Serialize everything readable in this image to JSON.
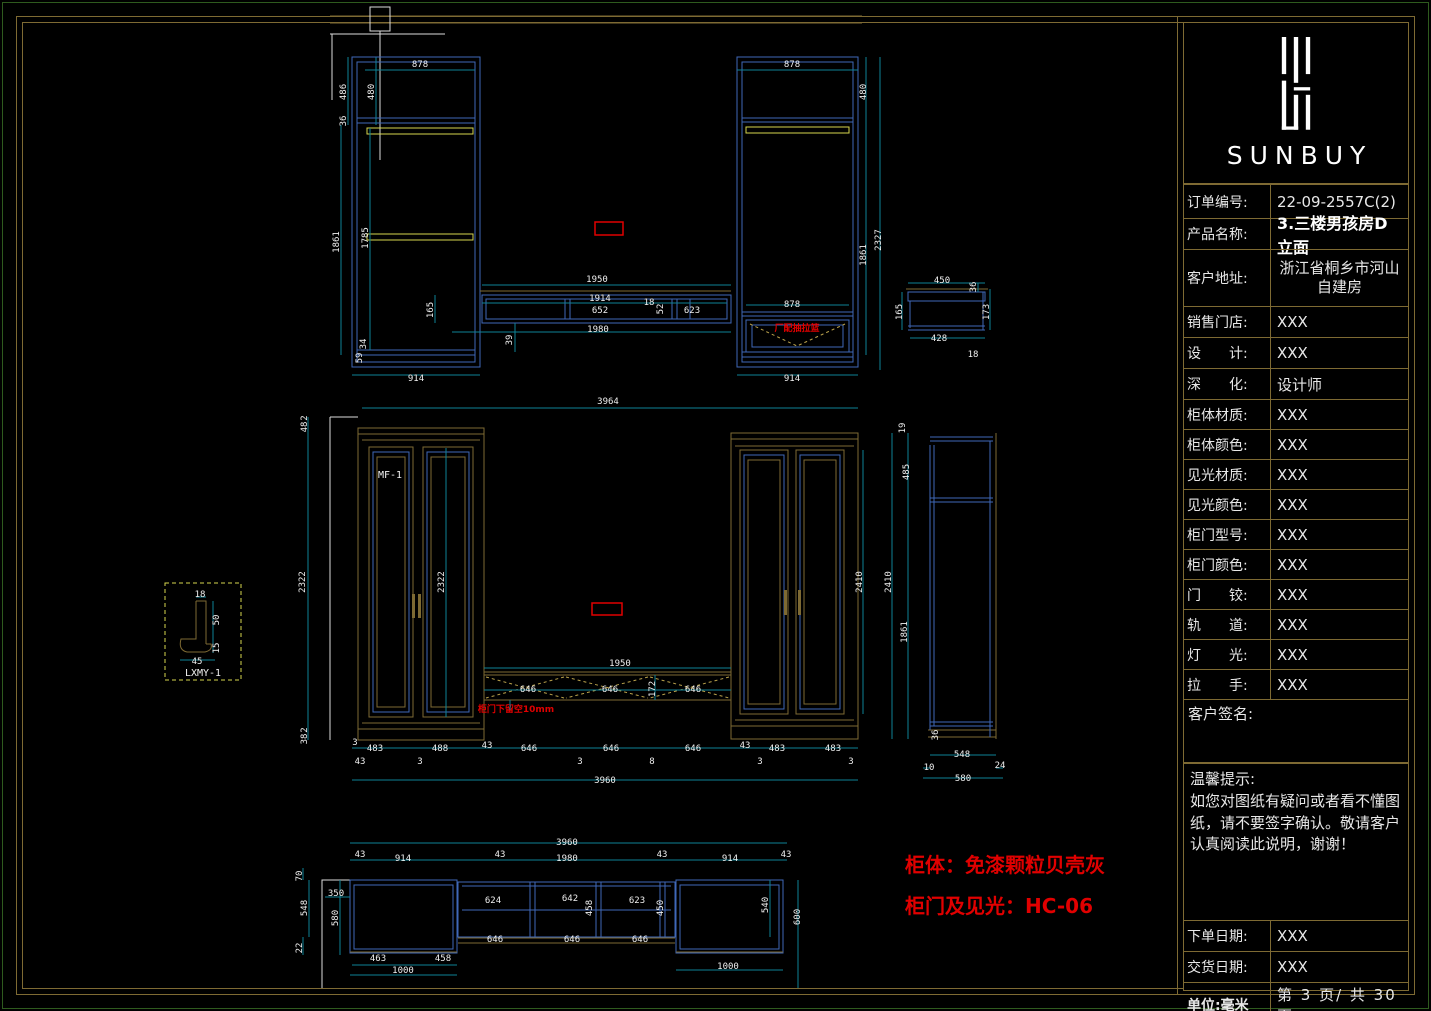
{
  "logo": {
    "brand": "SUNBUY"
  },
  "titleblock": {
    "rows": [
      {
        "label": "订单编号:",
        "value": "22-09-2557C(2)"
      },
      {
        "label": "产品名称:",
        "value": "3.三楼男孩房D立面"
      },
      {
        "label": "客户地址:",
        "value": "浙江省桐乡市河山自建房"
      },
      {
        "label": "销售门店:",
        "value": "XXX"
      },
      {
        "label": "设　　计:",
        "value": "XXX"
      },
      {
        "label": "深　　化:",
        "value": "设计师"
      },
      {
        "label": "柜体材质:",
        "value": "XXX"
      },
      {
        "label": "柜体颜色:",
        "value": "XXX"
      },
      {
        "label": "见光材质:",
        "value": "XXX"
      },
      {
        "label": "见光颜色:",
        "value": "XXX"
      },
      {
        "label": "柜门型号:",
        "value": "XXX"
      },
      {
        "label": "柜门颜色:",
        "value": "XXX"
      },
      {
        "label": "门　　铰:",
        "value": "XXX"
      },
      {
        "label": "轨　　道:",
        "value": "XXX"
      },
      {
        "label": "灯　　光:",
        "value": "XXX"
      },
      {
        "label": "拉　　手:",
        "value": "XXX"
      }
    ],
    "signature_label": "客户签名:",
    "notice_title": "温馨提示:",
    "notice_body": "如您对图纸有疑问或者看不懂图纸，请不要签字确认。敬请客户认真阅读此说明，谢谢！",
    "order_date_label": "下单日期:",
    "order_date": "XXX",
    "delivery_date_label": "交货日期:",
    "delivery_date": "XXX",
    "unit_label": "单位:毫米",
    "page_info": "第 3 页/ 共 30 页"
  },
  "notes": {
    "body_note": "柜体：免漆颗粒贝壳灰",
    "door_note": "柜门及见光：HC-06",
    "drawer_note": "厂配抽拉篮",
    "gap_note": "柜门下留空10mm"
  },
  "labels": {
    "door_model": "MF-1",
    "moulding_detail": "LXMY-1"
  },
  "colors": {
    "cad_blue": "#3f68b8",
    "cad_gold": "#7e6a33",
    "cad_yellow": "#d6d64e",
    "dim_cyan": "#0e8296",
    "note_red": "#e10000"
  },
  "dims": {
    "top": [
      {
        "x": 420,
        "y": 67,
        "t": "878"
      },
      {
        "x": 346,
        "y": 92,
        "t": "486",
        "r": 1
      },
      {
        "x": 374,
        "y": 92,
        "t": "480",
        "r": 1
      },
      {
        "x": 346,
        "y": 121,
        "t": "36",
        "r": 1
      },
      {
        "x": 339,
        "y": 242,
        "t": "1861",
        "r": 1
      },
      {
        "x": 368,
        "y": 238,
        "t": "1785",
        "r": 1
      },
      {
        "x": 366,
        "y": 344,
        "t": "34",
        "r": 1
      },
      {
        "x": 362,
        "y": 358,
        "t": "59",
        "r": 1
      },
      {
        "x": 416,
        "y": 381,
        "t": "914"
      },
      {
        "x": 597,
        "y": 282,
        "t": "1950"
      },
      {
        "x": 600,
        "y": 301,
        "t": "1914"
      },
      {
        "x": 600,
        "y": 313,
        "t": "652"
      },
      {
        "x": 649,
        "y": 305,
        "t": "18"
      },
      {
        "x": 663,
        "y": 309,
        "t": "52",
        "r": 1
      },
      {
        "x": 692,
        "y": 313,
        "t": "623"
      },
      {
        "x": 598,
        "y": 332,
        "t": "1980"
      },
      {
        "x": 433,
        "y": 310,
        "t": "165",
        "r": 1
      },
      {
        "x": 512,
        "y": 340,
        "t": "39",
        "r": 1
      },
      {
        "x": 792,
        "y": 67,
        "t": "878"
      },
      {
        "x": 792,
        "y": 307,
        "t": "878"
      },
      {
        "x": 792,
        "y": 381,
        "t": "914"
      },
      {
        "x": 866,
        "y": 92,
        "t": "480",
        "r": 1
      },
      {
        "x": 881,
        "y": 240,
        "t": "2327",
        "r": 1
      },
      {
        "x": 866,
        "y": 255,
        "t": "1861",
        "r": 1
      },
      {
        "x": 942,
        "y": 283,
        "t": "450"
      },
      {
        "x": 976,
        "y": 287,
        "t": "36",
        "r": 1
      },
      {
        "x": 902,
        "y": 312,
        "t": "165",
        "r": 1
      },
      {
        "x": 989,
        "y": 312,
        "t": "173",
        "r": 1
      },
      {
        "x": 939,
        "y": 341,
        "t": "428"
      },
      {
        "x": 973,
        "y": 357,
        "t": "18"
      }
    ],
    "middle": [
      {
        "x": 608,
        "y": 404,
        "t": "3964"
      },
      {
        "x": 307,
        "y": 418,
        "t": "2",
        "r": 1
      },
      {
        "x": 307,
        "y": 427,
        "t": "48",
        "r": 1
      },
      {
        "x": 305,
        "y": 582,
        "t": "2322",
        "r": 1
      },
      {
        "x": 307,
        "y": 730,
        "t": "2",
        "r": 1
      },
      {
        "x": 307,
        "y": 739,
        "t": "38",
        "r": 1
      },
      {
        "x": 444,
        "y": 582,
        "t": "2322",
        "r": 1
      },
      {
        "x": 620,
        "y": 666,
        "t": "1950"
      },
      {
        "x": 528,
        "y": 692,
        "t": "646"
      },
      {
        "x": 610,
        "y": 692,
        "t": "646"
      },
      {
        "x": 693,
        "y": 692,
        "t": "646"
      },
      {
        "x": 655,
        "y": 689,
        "t": "172",
        "r": 1
      },
      {
        "x": 862,
        "y": 582,
        "t": "2410",
        "r": 1
      },
      {
        "x": 891,
        "y": 582,
        "t": "2410",
        "r": 1
      },
      {
        "x": 905,
        "y": 428,
        "t": "19",
        "r": 1
      },
      {
        "x": 909,
        "y": 472,
        "t": "485",
        "r": 1
      },
      {
        "x": 907,
        "y": 632,
        "t": "1861",
        "r": 1
      },
      {
        "x": 938,
        "y": 735,
        "t": "36",
        "r": 1
      },
      {
        "x": 962,
        "y": 757,
        "t": "548"
      },
      {
        "x": 929,
        "y": 770,
        "t": "10"
      },
      {
        "x": 1000,
        "y": 768,
        "t": "24"
      },
      {
        "x": 963,
        "y": 781,
        "t": "580"
      },
      {
        "x": 355,
        "y": 745,
        "t": "3"
      },
      {
        "x": 375,
        "y": 751,
        "t": "483"
      },
      {
        "x": 440,
        "y": 751,
        "t": "488"
      },
      {
        "x": 487,
        "y": 748,
        "t": "43"
      },
      {
        "x": 529,
        "y": 751,
        "t": "646"
      },
      {
        "x": 611,
        "y": 751,
        "t": "646"
      },
      {
        "x": 693,
        "y": 751,
        "t": "646"
      },
      {
        "x": 745,
        "y": 748,
        "t": "43"
      },
      {
        "x": 777,
        "y": 751,
        "t": "483"
      },
      {
        "x": 833,
        "y": 751,
        "t": "483"
      },
      {
        "x": 360,
        "y": 764,
        "t": "43"
      },
      {
        "x": 420,
        "y": 764,
        "t": "3"
      },
      {
        "x": 580,
        "y": 764,
        "t": "3"
      },
      {
        "x": 652,
        "y": 764,
        "t": "8"
      },
      {
        "x": 760,
        "y": 764,
        "t": "3"
      },
      {
        "x": 851,
        "y": 764,
        "t": "3"
      },
      {
        "x": 605,
        "y": 783,
        "t": "3960"
      },
      {
        "x": 200,
        "y": 597,
        "t": "18"
      },
      {
        "x": 219,
        "y": 620,
        "t": "50",
        "r": 1
      },
      {
        "x": 219,
        "y": 648,
        "t": "15",
        "r": 1
      },
      {
        "x": 197,
        "y": 664,
        "t": "45"
      }
    ],
    "plan": [
      {
        "x": 567,
        "y": 845,
        "t": "3960"
      },
      {
        "x": 360,
        "y": 857,
        "t": "43"
      },
      {
        "x": 403,
        "y": 861,
        "t": "914"
      },
      {
        "x": 500,
        "y": 857,
        "t": "43"
      },
      {
        "x": 567,
        "y": 861,
        "t": "1980"
      },
      {
        "x": 662,
        "y": 857,
        "t": "43"
      },
      {
        "x": 730,
        "y": 861,
        "t": "914"
      },
      {
        "x": 786,
        "y": 857,
        "t": "43"
      },
      {
        "x": 302,
        "y": 876,
        "t": "70",
        "r": 1
      },
      {
        "x": 336,
        "y": 896,
        "t": "350"
      },
      {
        "x": 307,
        "y": 908,
        "t": "548",
        "r": 1
      },
      {
        "x": 338,
        "y": 918,
        "t": "580",
        "r": 1
      },
      {
        "x": 302,
        "y": 948,
        "t": "22",
        "r": 1
      },
      {
        "x": 493,
        "y": 903,
        "t": "624"
      },
      {
        "x": 570,
        "y": 901,
        "t": "642"
      },
      {
        "x": 637,
        "y": 903,
        "t": "623"
      },
      {
        "x": 592,
        "y": 908,
        "t": "458",
        "r": 1
      },
      {
        "x": 663,
        "y": 908,
        "t": "450",
        "r": 1
      },
      {
        "x": 495,
        "y": 942,
        "t": "646"
      },
      {
        "x": 572,
        "y": 942,
        "t": "646"
      },
      {
        "x": 640,
        "y": 942,
        "t": "646"
      },
      {
        "x": 378,
        "y": 961,
        "t": "463"
      },
      {
        "x": 443,
        "y": 961,
        "t": "458"
      },
      {
        "x": 403,
        "y": 973,
        "t": "1000"
      },
      {
        "x": 728,
        "y": 969,
        "t": "1000"
      },
      {
        "x": 768,
        "y": 905,
        "t": "540",
        "r": 1
      },
      {
        "x": 800,
        "y": 917,
        "t": "600",
        "r": 1
      }
    ]
  }
}
